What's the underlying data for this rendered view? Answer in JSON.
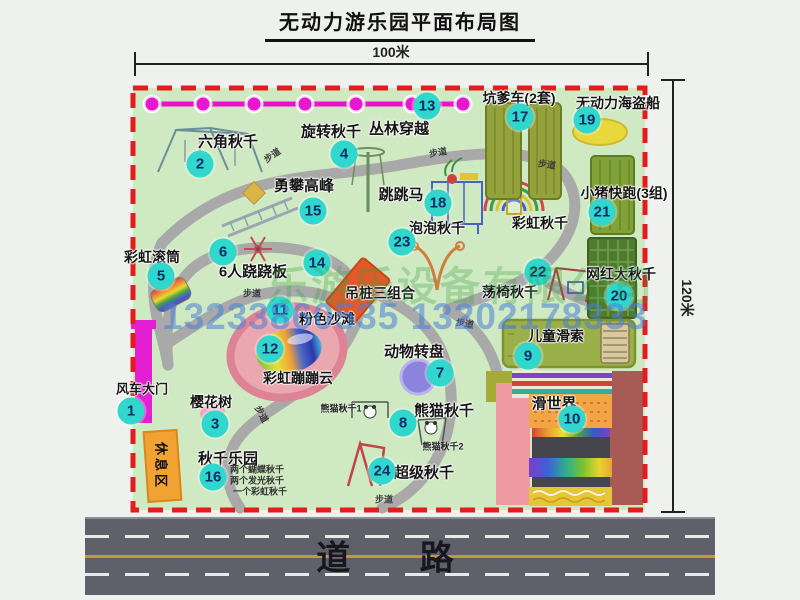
{
  "title": "无动力游乐园平面布局图",
  "dimensions": {
    "width_label": "100米",
    "height_label": "120米"
  },
  "road_label": "道 路",
  "walkway_label": "步道",
  "rest_area_label": "休息区",
  "watermark": {
    "company": "乐游乐设备有限公司",
    "phone": "13233860535 13202178333"
  },
  "rainbow_swing": {
    "label": "彩虹秋千"
  },
  "attractions": [
    {
      "num": "1",
      "label": "风车大门"
    },
    {
      "num": "2",
      "label": "六角秋千"
    },
    {
      "num": "3",
      "label": "樱花树"
    },
    {
      "num": "4",
      "label": "旋转秋千"
    },
    {
      "num": "5",
      "label": "彩虹滚筒"
    },
    {
      "num": "6",
      "label": "6人跷跷板"
    },
    {
      "num": "7",
      "label": "动物转盘"
    },
    {
      "num": "8",
      "label": "熊猫秋千",
      "notes": [
        "熊猫秋千1",
        "熊猫秋千2"
      ]
    },
    {
      "num": "9",
      "label": "儿童滑索"
    },
    {
      "num": "10",
      "label": "滑世界"
    },
    {
      "num": "11",
      "label": "粉色沙滩"
    },
    {
      "num": "12",
      "label": "彩虹蹦蹦云"
    },
    {
      "num": "13",
      "label": "丛林穿越"
    },
    {
      "num": "14",
      "label": "吊桩三组合"
    },
    {
      "num": "15",
      "label": "勇攀高峰"
    },
    {
      "num": "16",
      "label": "秋千乐园",
      "notes": [
        "两个蝴蝶秋千",
        "两个发光秋千",
        "一个彩虹秋千"
      ]
    },
    {
      "num": "17",
      "label": "坑爹车(2套)"
    },
    {
      "num": "18",
      "label": "跳跳马"
    },
    {
      "num": "19",
      "label": "无动力海盗船"
    },
    {
      "num": "20",
      "label": "网红大秋千"
    },
    {
      "num": "21",
      "label": "小猪快跑(3组)"
    },
    {
      "num": "22",
      "label": "荡椅秋千"
    },
    {
      "num": "23",
      "label": "泡泡秋千"
    },
    {
      "num": "24",
      "label": "超级秋千"
    }
  ],
  "colors": {
    "park_green": "#cfe9c2",
    "boundary_red": "#e31c1c",
    "badge_cyan": "#30d7cd",
    "badge_text": "#0a2d66",
    "path_gray": "#a9a9a9",
    "road_gray": "#60606a",
    "zipline_magenta": "#e617cf",
    "gate_magenta": "#e21fd3",
    "rest_area_orange": "#f2a233"
  }
}
